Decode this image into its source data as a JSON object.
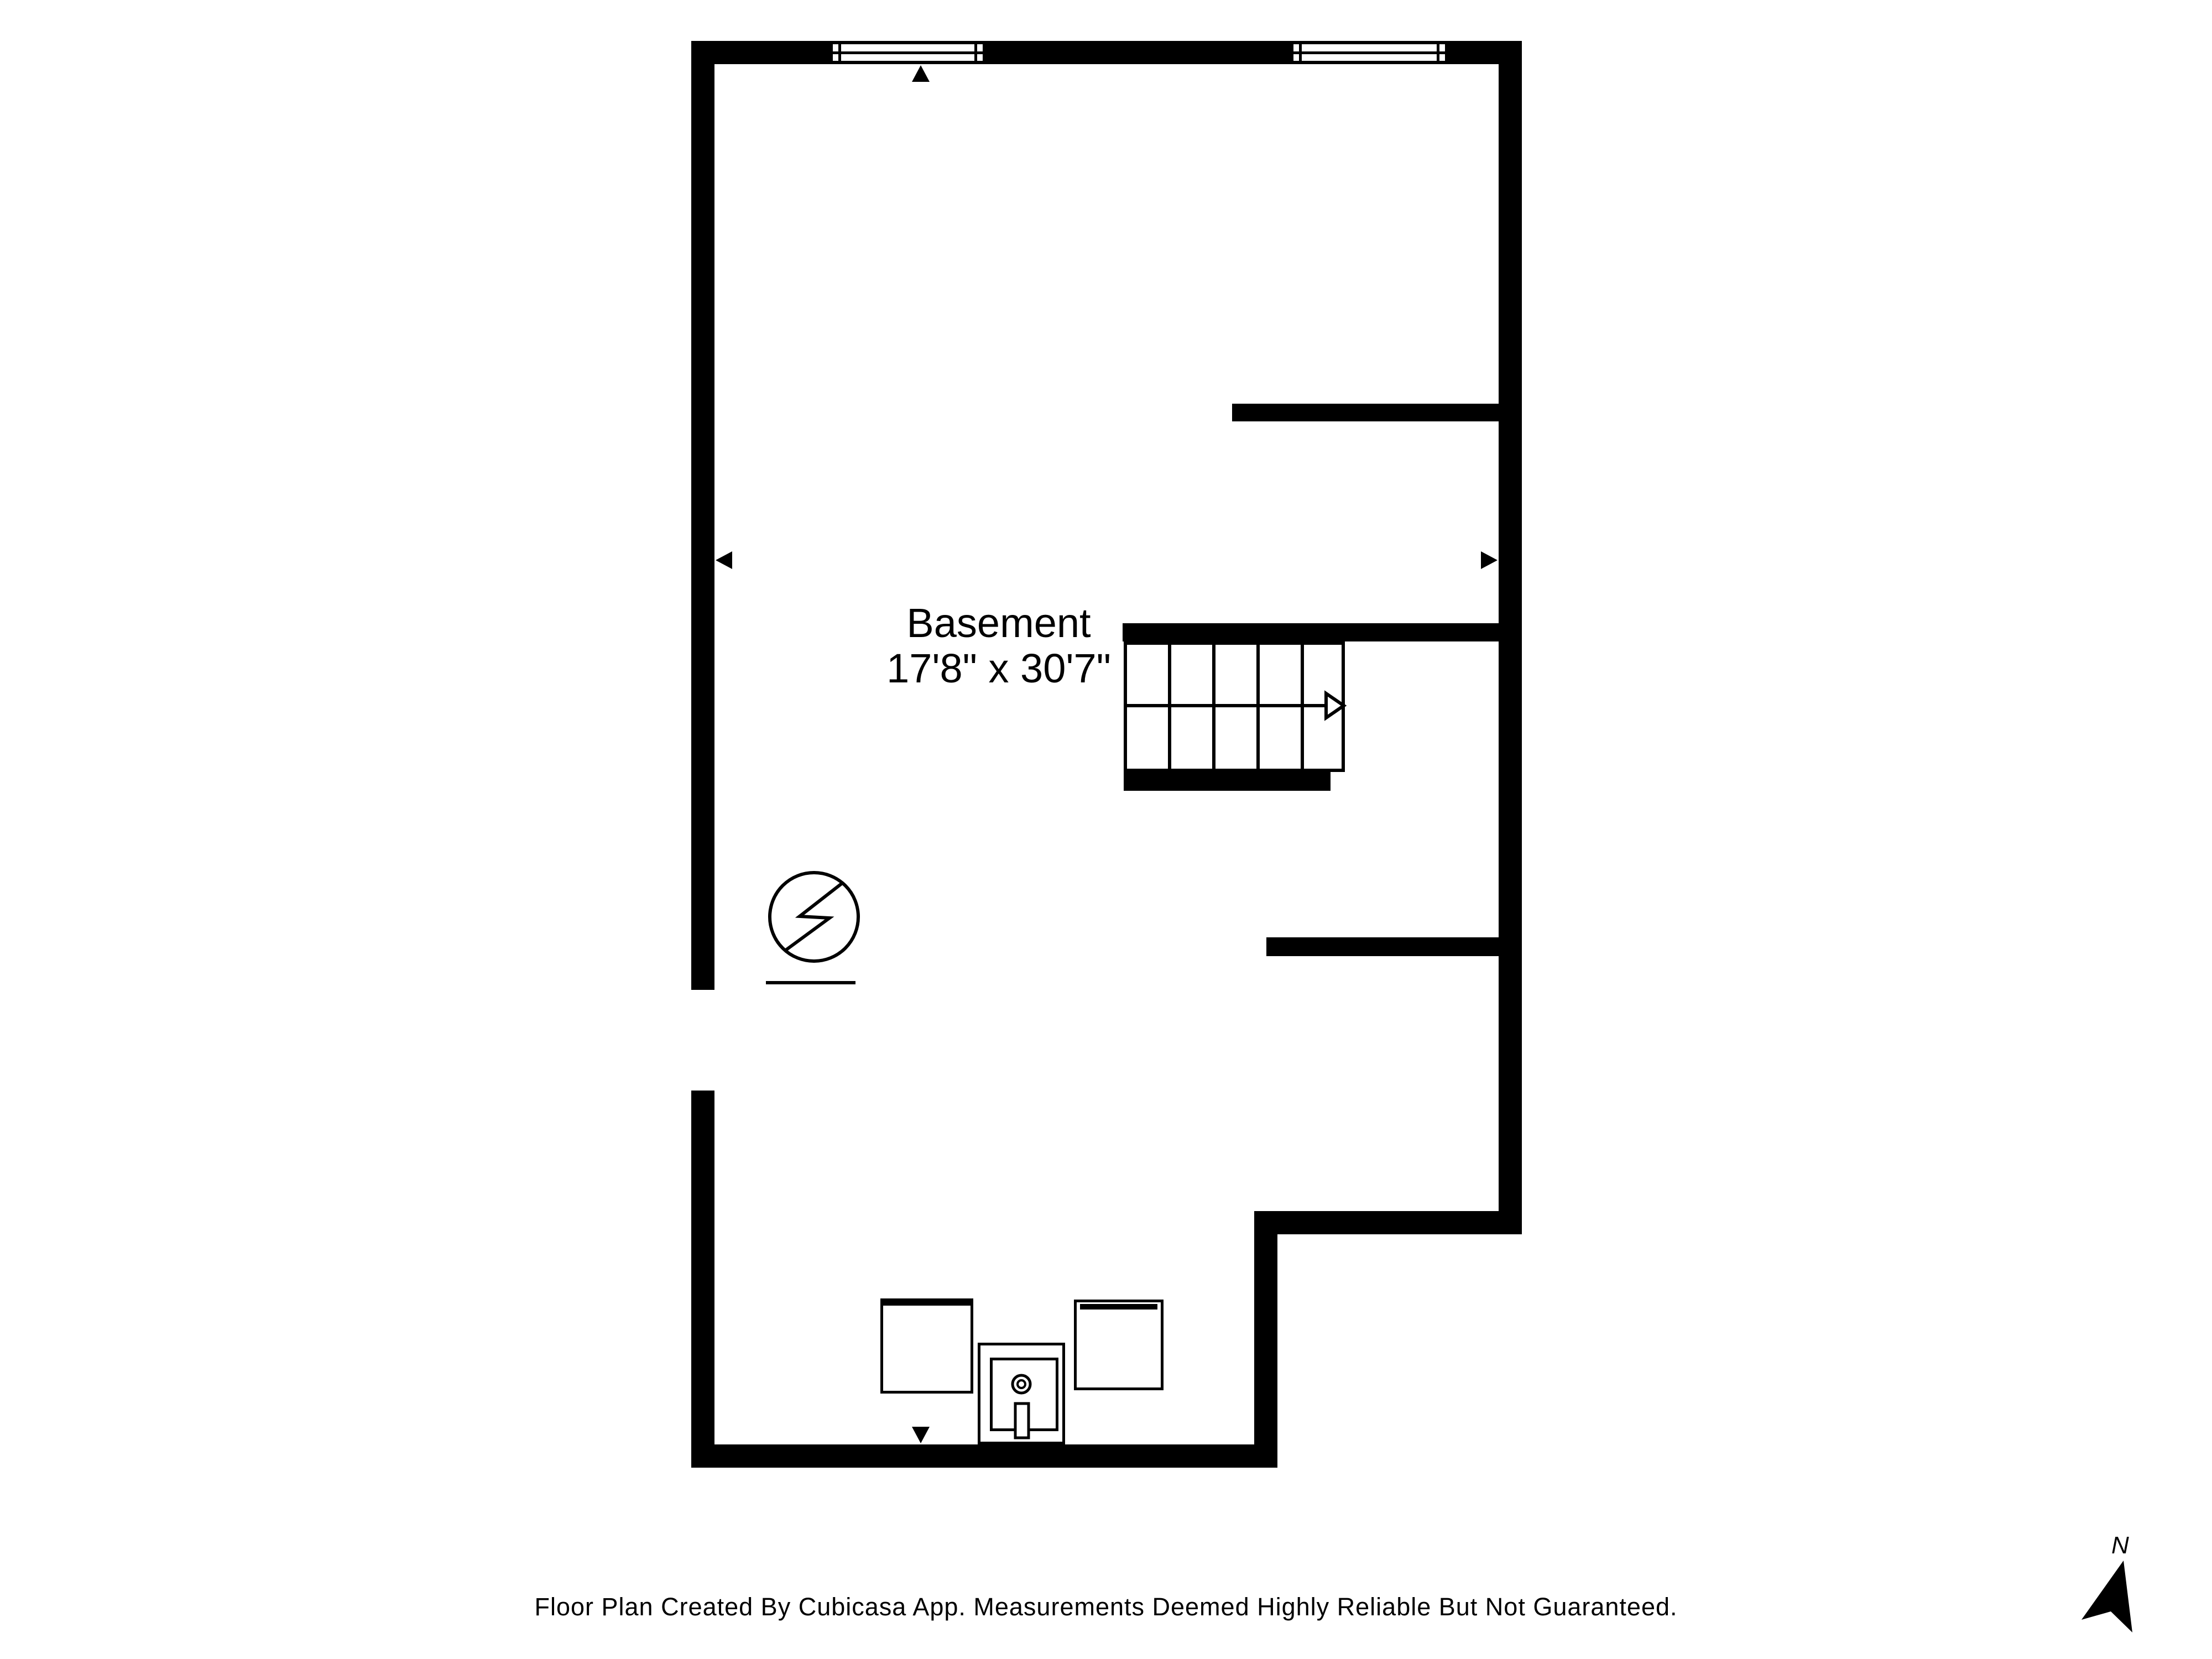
{
  "floor_plan": {
    "room": {
      "name": "Basement",
      "dimensions": "17'8\" x 30'7\""
    },
    "footer": "Floor Plan Created By Cubicasa App. Measurements Deemed Highly Reliable But Not Guaranteed.",
    "compass": {
      "label": "N",
      "direction": "north"
    },
    "colors": {
      "wall": "#000000",
      "background": "#ffffff",
      "line": "#000000"
    },
    "stairs": {
      "steps_per_flight": 5,
      "flights": 2,
      "direction_arrow": "right"
    },
    "symbols": [
      "electrical-panel-icon",
      "utility-sink-icon",
      "appliance-box",
      "compass-north-icon",
      "window-symbol",
      "measurement-arrow"
    ],
    "windows_count": 2,
    "door_openings_count": 1
  }
}
